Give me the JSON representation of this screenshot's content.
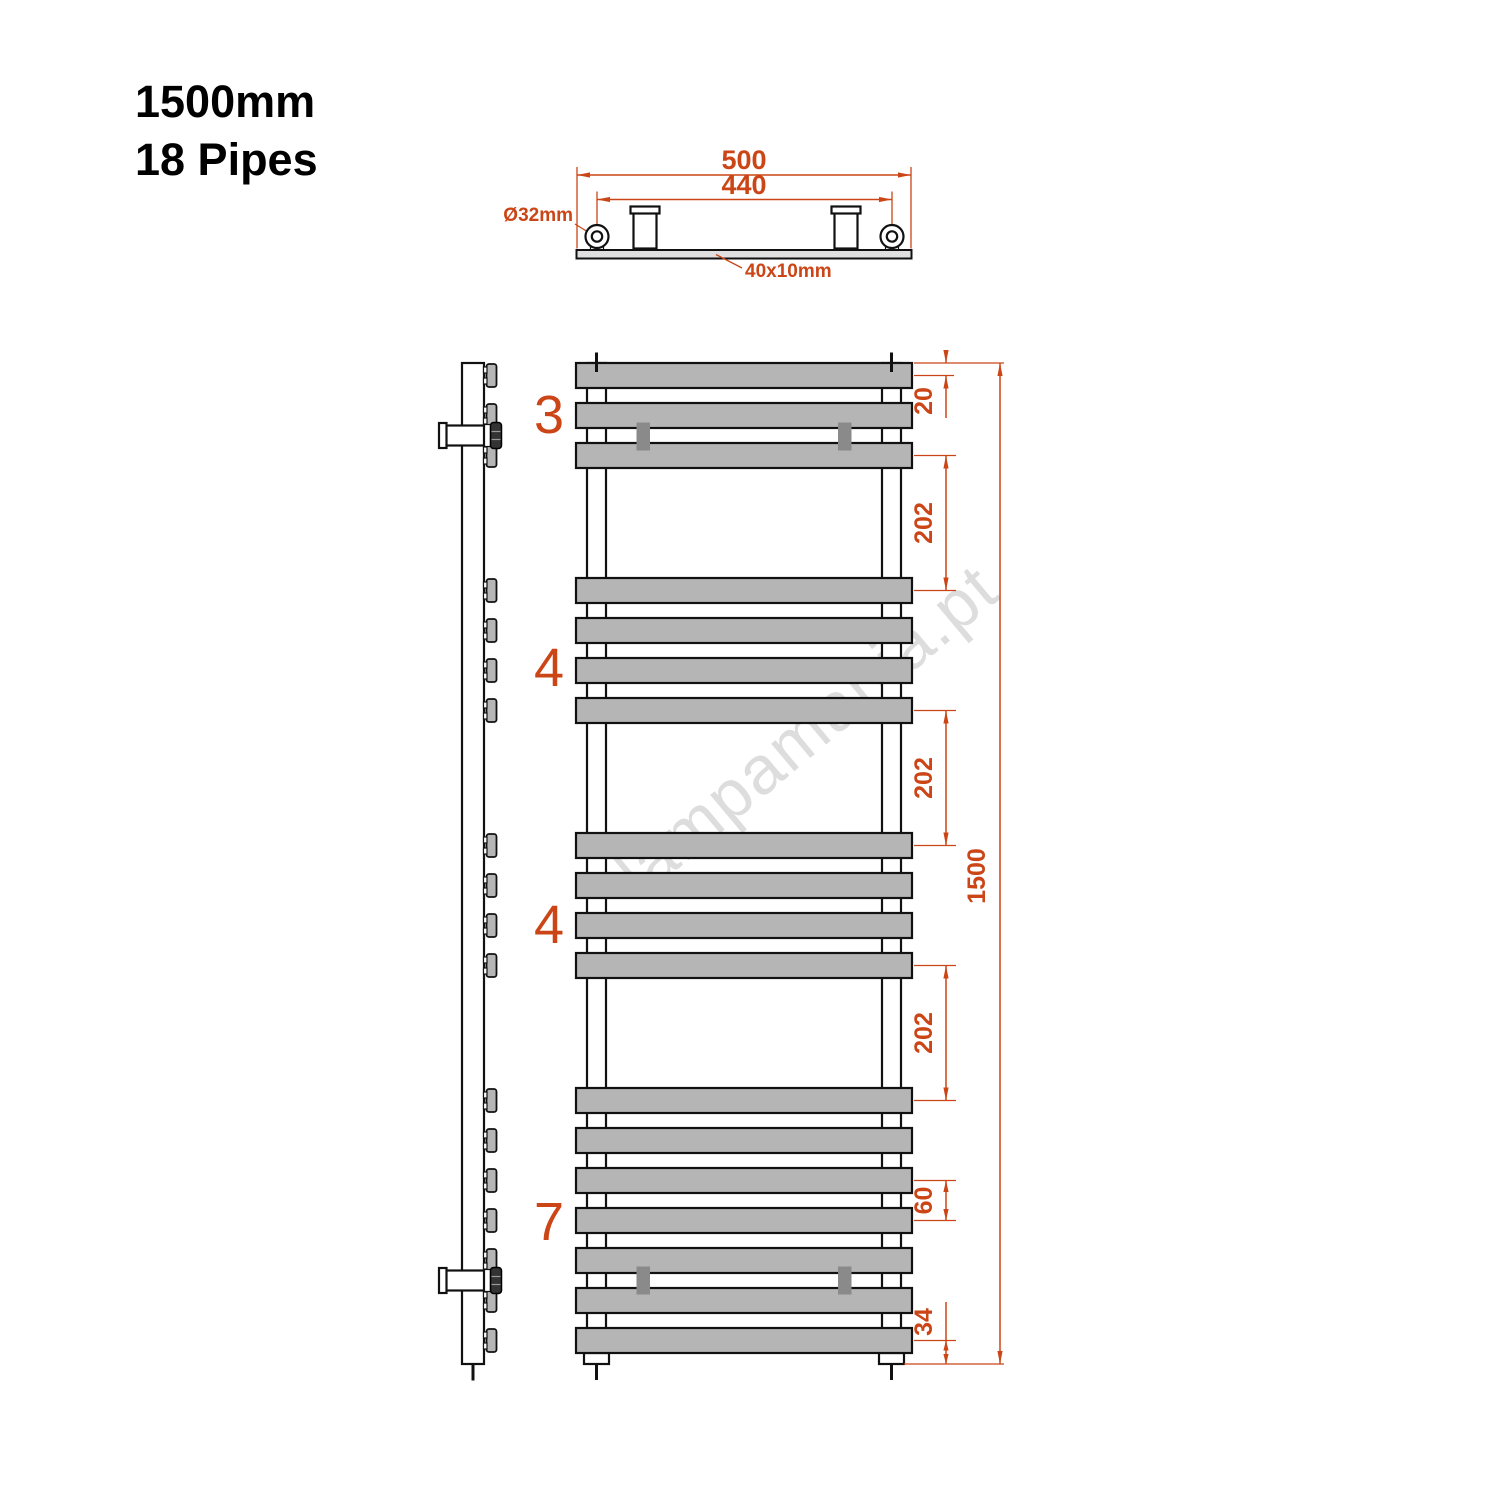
{
  "title": {
    "line1": "1500mm",
    "line2": "18 Pipes"
  },
  "watermark": "lampamania.pt",
  "colors": {
    "dimension": "#cb4517",
    "pipe_fill": "#b5b5b5",
    "bracket_fill": "#8a8a8a",
    "outline": "#111111",
    "plate_fill": "#e0e0e0",
    "watermark_gray": "#c2c2c2"
  },
  "top_view": {
    "overall_width": "500",
    "hole_spacing": "440",
    "tube_diameter": "Ø32mm",
    "profile_size": "40x10mm"
  },
  "front_view": {
    "groups": [
      {
        "label": "3",
        "pipe_count": 3
      },
      {
        "label": "4",
        "pipe_count": 4
      },
      {
        "label": "4",
        "pipe_count": 4
      },
      {
        "label": "7",
        "pipe_count": 7
      }
    ],
    "total_pipes": 18
  },
  "dimensions": {
    "top_to_first_pipe_center": "20",
    "group_gap": "202",
    "pipe_pitch": "60",
    "last_pipe_center_to_bottom": "34",
    "overall_height": "1500"
  }
}
